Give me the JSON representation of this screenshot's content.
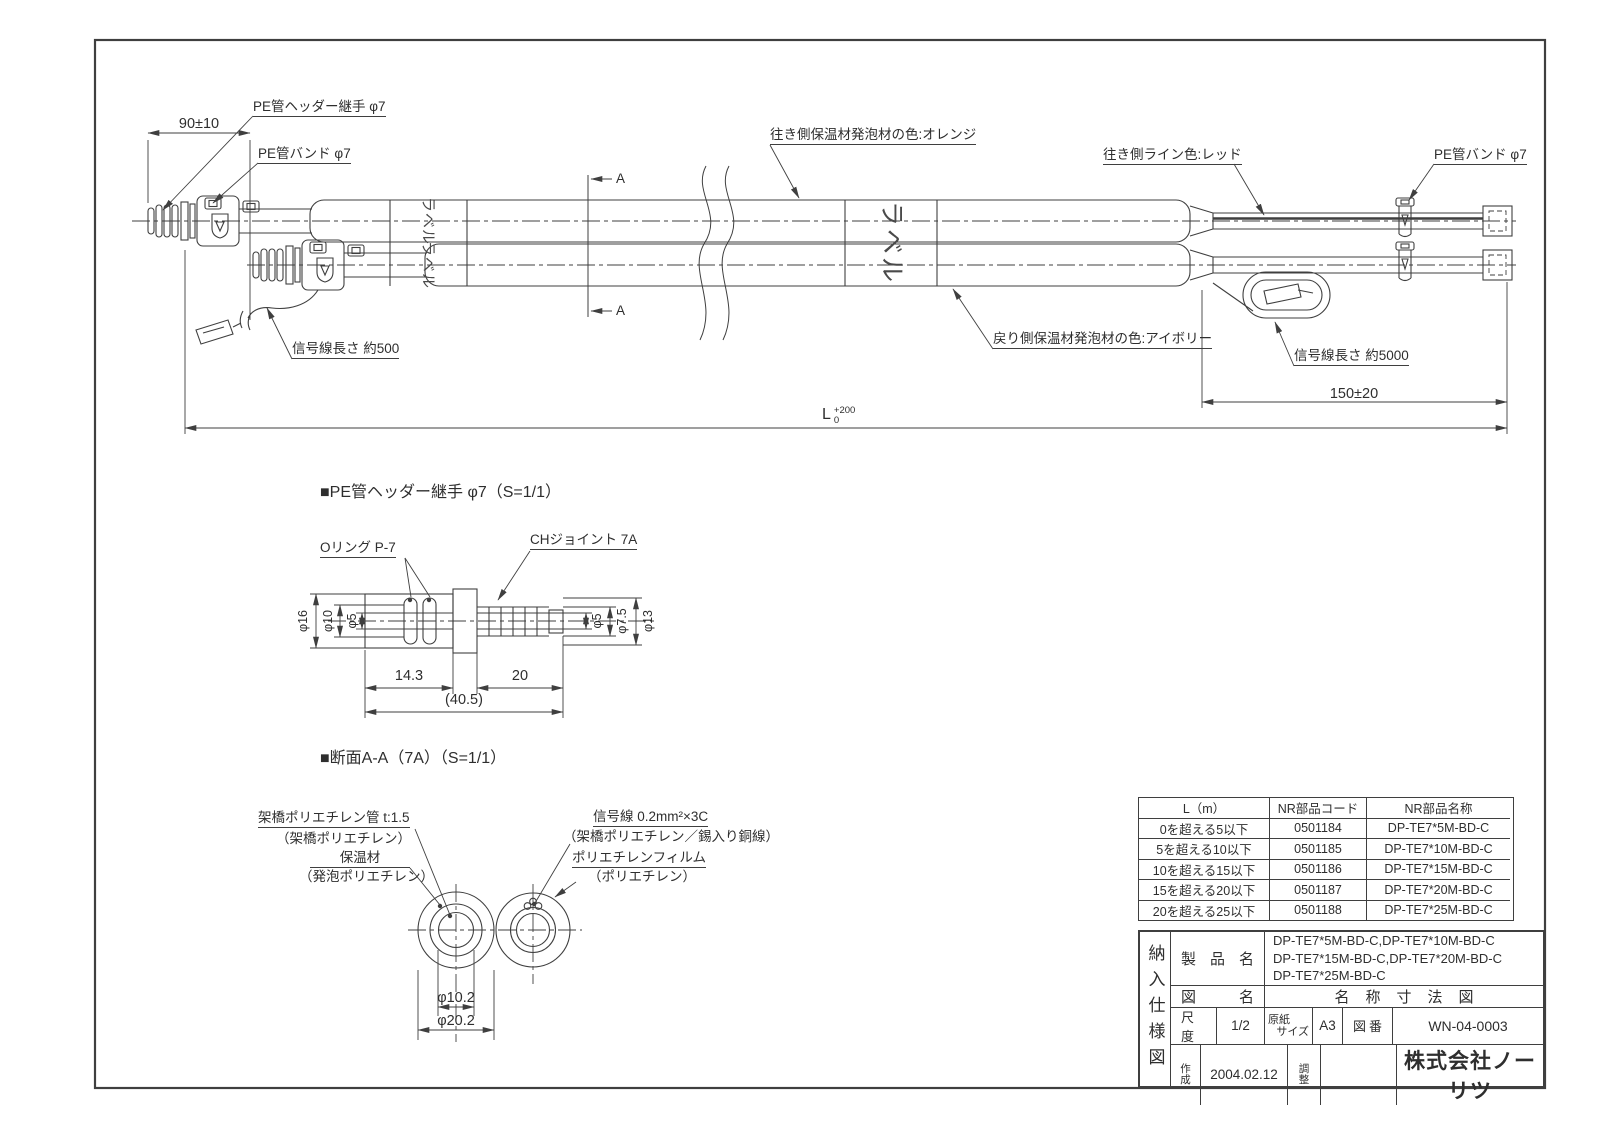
{
  "colors": {
    "line": "#3f3f3f",
    "text": "#2e2e2e",
    "bg": "#ffffff"
  },
  "main_view": {
    "labels": {
      "pe_header_joint": "PE管ヘッダー継手 φ7",
      "pe_band_left": "PE管バンド φ7",
      "dim_90": "90±10",
      "outgoing_foam_color": "往き側保温材発泡材の色:オレンジ",
      "outgoing_line_color": "往き側ライン色:レッド",
      "pe_band_right": "PE管バンド φ7",
      "return_foam_color": "戻り側保温材発泡材の色:アイボリー",
      "signal_length_right": "信号線長さ 約5000",
      "signal_length_left": "信号線長さ 約500",
      "dim_150": "150±20",
      "dim_length_symbol": "L",
      "dim_length_tol_upper": "+200",
      "dim_length_tol_lower": "0",
      "section_mark": "A",
      "label_sticker": "ラベル"
    }
  },
  "detail_joint": {
    "title": "■PE管ヘッダー継手 φ7（S=1/1）",
    "oring_label": "Oリング P-7",
    "ch_joint_label": "CHジョイント 7A",
    "dims": {
      "d16": "φ16",
      "d10": "φ10",
      "d5_left": "φ5",
      "d5_right": "φ5",
      "d75": "φ7.5",
      "d13": "φ13",
      "w143": "14.3",
      "w20": "20",
      "w405": "(40.5)"
    }
  },
  "section_aa": {
    "title": "■断面A-A（7A）（S=1/1）",
    "pipe_label": "架橋ポリエチレン管 t:1.5",
    "pipe_material": "（架橋ポリエチレン）",
    "insulation_label": "保温材",
    "insulation_material": "（発泡ポリエチレン）",
    "signal_label": "信号線 0.2mm²×3C",
    "signal_material": "（架橋ポリエチレン／錫入り銅線）",
    "film_label": "ポリエチレンフィルム",
    "film_material": "（ポリエチレン）",
    "dims": {
      "d102": "φ10.2",
      "d202": "φ20.2"
    }
  },
  "parts_table": {
    "headers": [
      "L（m）",
      "NR部品コード",
      "NR部品名称"
    ],
    "rows": [
      {
        "range": "0を超える5以下",
        "code": "0501184",
        "name": "DP-TE7*5M-BD-C"
      },
      {
        "range": "5を超える10以下",
        "code": "0501185",
        "name": "DP-TE7*10M-BD-C"
      },
      {
        "range": "10を超える15以下",
        "code": "0501186",
        "name": "DP-TE7*15M-BD-C"
      },
      {
        "range": "15を超える20以下",
        "code": "0501187",
        "name": "DP-TE7*20M-BD-C"
      },
      {
        "range": "20を超える25以下",
        "code": "0501188",
        "name": "DP-TE7*25M-BD-C"
      }
    ]
  },
  "title_block": {
    "doc_type": "納入仕様図",
    "product_label": "製品名",
    "product_line1": "DP-TE7*5M-BD-C,DP-TE7*10M-BD-C",
    "product_line2": "DP-TE7*15M-BD-C,DP-TE7*20M-BD-C",
    "product_line3": "DP-TE7*25M-BD-C",
    "drawing_label": "図名",
    "drawing_name": "名称寸法図",
    "scale_label": "尺度",
    "scale_value": "1/2",
    "paper_label1": "原紙",
    "paper_label2": "サイズ",
    "paper_value": "A3",
    "number_label": "図番",
    "number_value": "WN-04-0003",
    "created_label": "作成",
    "created_value": "2004.02.12",
    "adjust_label": "調整",
    "company": "株式会社ノーリツ"
  }
}
